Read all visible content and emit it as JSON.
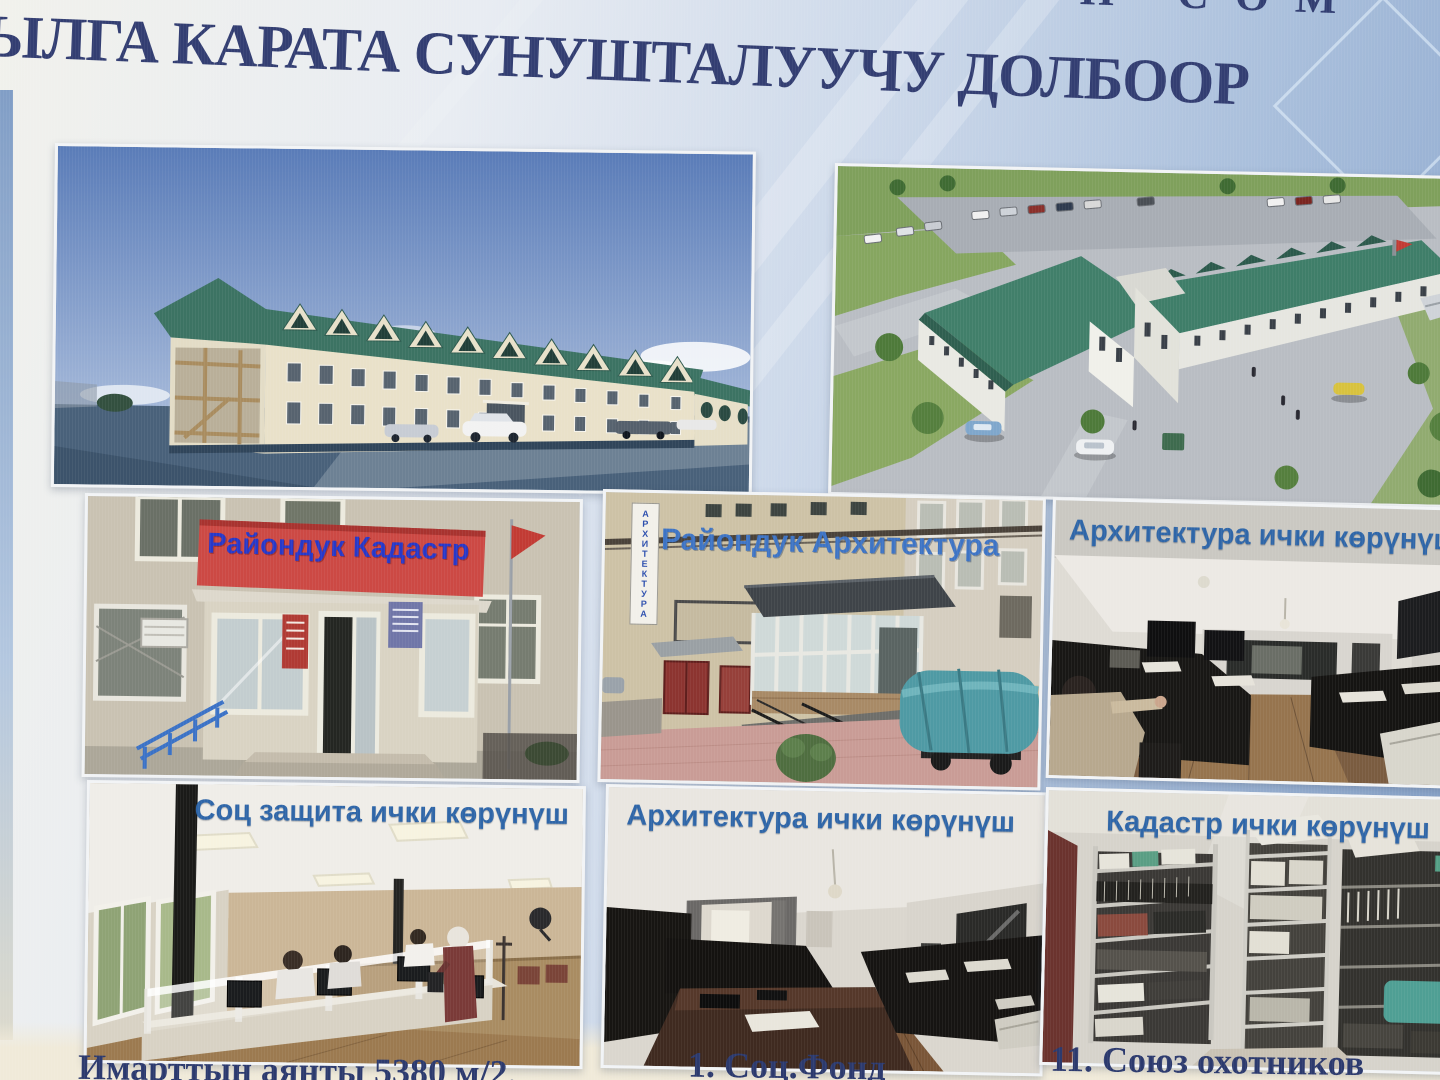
{
  "poster": {
    "top_line_fragment": "Н СОМ",
    "title": "ЫЛГА КАРАТА СУНУШТАЛУУЧУ ДОЛБООР",
    "gallery": {
      "kadastr_building": {
        "sign": "Райондук Кадастр"
      },
      "arch_building": {
        "caption": "Райондук Архитектура",
        "vertical_sign": "АРХИТЕКТУРА"
      },
      "arch_interior": {
        "caption": "Архитектура ички көрүнүш"
      },
      "soc_interior": {
        "caption": "Соц защита ички көрүнүш"
      },
      "arch_interior_2": {
        "caption": "Архитектура ички көрүнүш"
      },
      "kadastr_interior": {
        "caption": "Кадастр ички көрүнүш"
      }
    },
    "footer": {
      "building_area": "Имарттын аянты 5380 м/2.",
      "soc_fund": "1. Соц.Фонд",
      "hunters_union": "11. Союз охотников"
    },
    "colors": {
      "title_ink": "#333e72",
      "caption_blue": "#2f66a8",
      "banner_red": "#c94641",
      "banner_text_blue": "#2838c8",
      "roof_green": "#3f7e69",
      "bottom_paper": "#f0ead9"
    }
  }
}
